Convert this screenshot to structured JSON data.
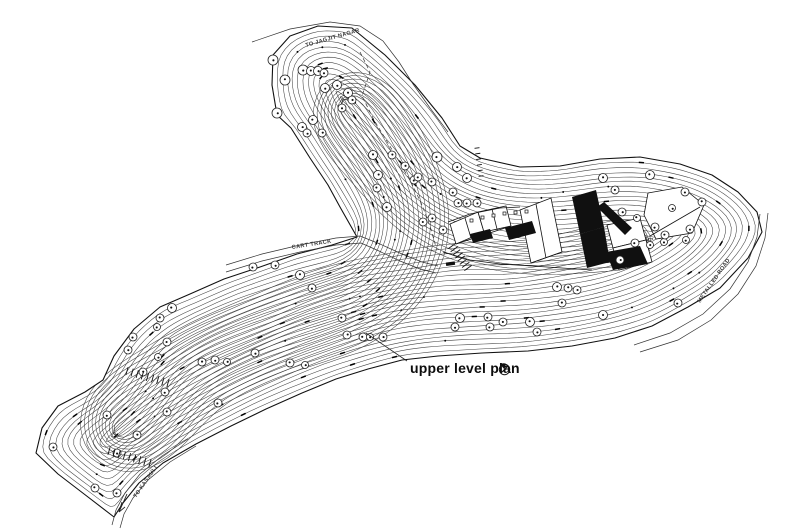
{
  "page": {
    "paper_color": "#ffffff",
    "ink_color": "#1c1c1c"
  },
  "title": {
    "label": "upper level plan",
    "symbol": "north-indicator"
  },
  "annotations": {
    "road_top_label": "TO JAGJIT NAGAR",
    "cart_track_label": "CART TRACK",
    "metalled_road_label": "METALLED ROAD",
    "road_bottom_label": "TO KASAULI"
  },
  "drawing": {
    "kind": "site contour plan with building cluster",
    "features": [
      "contour lines",
      "tree circles",
      "cart track",
      "metalled road",
      "building complex"
    ]
  }
}
